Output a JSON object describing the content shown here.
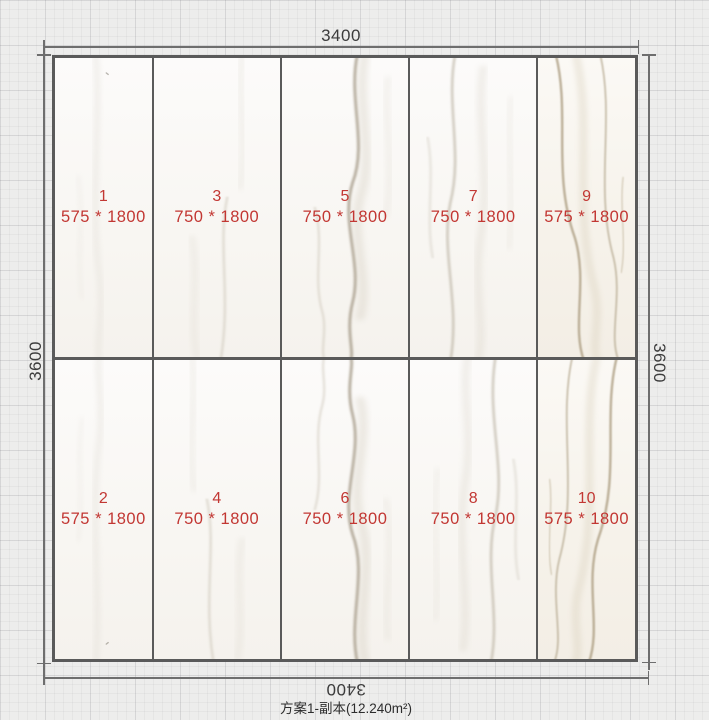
{
  "title": "方案1-副本(12.240m²)",
  "dimensions": {
    "top": "3400",
    "bottom": "3400",
    "left": "3600",
    "right": "3600"
  },
  "tiles": [
    {
      "num": "1",
      "size": "575 * 1800"
    },
    {
      "num": "3",
      "size": "750 * 1800"
    },
    {
      "num": "5",
      "size": "750 * 1800"
    },
    {
      "num": "7",
      "size": "750 * 1800"
    },
    {
      "num": "9",
      "size": "575 * 1800"
    },
    {
      "num": "2",
      "size": "575 * 1800"
    },
    {
      "num": "4",
      "size": "750 * 1800"
    },
    {
      "num": "6",
      "size": "750 * 1800"
    },
    {
      "num": "8",
      "size": "750 * 1800"
    },
    {
      "num": "10",
      "size": "575 * 1800"
    }
  ],
  "colors": {
    "accent_red": "#c23733",
    "dimension_text": "#3c3c3c",
    "tile_border": "#5a5a5a",
    "canvas_grid": "#ededec"
  }
}
